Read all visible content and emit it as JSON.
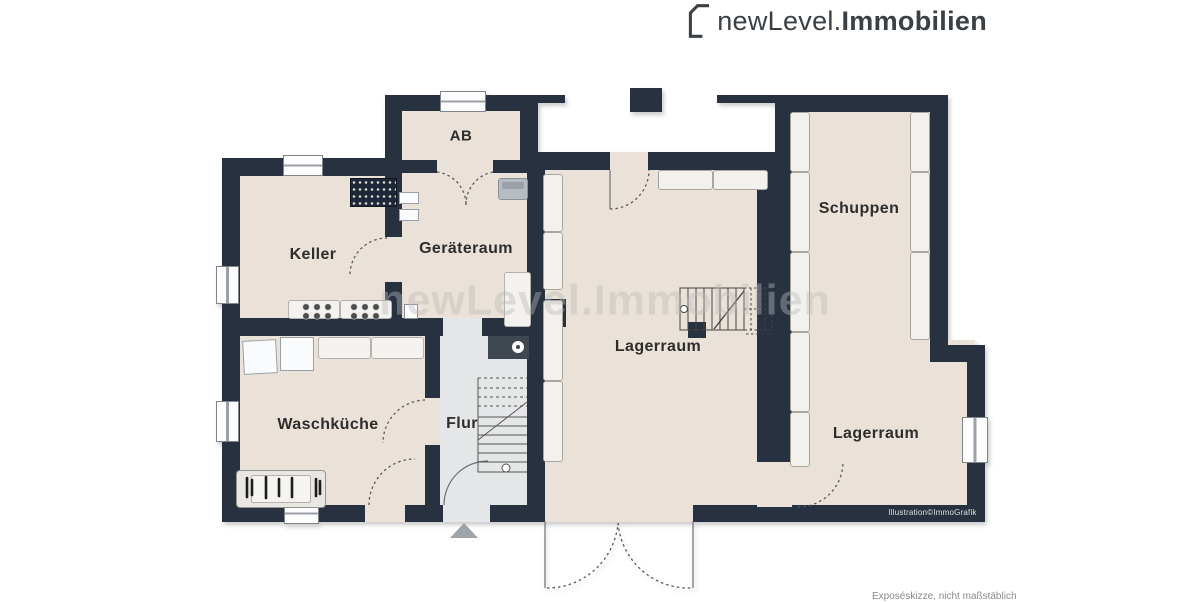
{
  "brand": {
    "logo_prefix": "newLevel.",
    "logo_suffix": "Immobilien"
  },
  "watermark_text": "newLevel.Immobilien",
  "rooms": [
    {
      "label": "AB"
    },
    {
      "label": "Keller"
    },
    {
      "label": "Geräteraum"
    },
    {
      "label": "Waschküche"
    },
    {
      "label": "Flur"
    },
    {
      "label": "Lagerraum"
    },
    {
      "label": "Schuppen"
    },
    {
      "label": "Lagerraum"
    }
  ],
  "credits": {
    "illustration": "Illustration©ImmoGrafik",
    "disclaimer": "Exposéskizze, nicht maßstäblich"
  },
  "colors": {
    "wall": "#273140",
    "floor": "#eae2d8",
    "floor_hall": "#e5e6e8",
    "furniture_light": "#f3f1ed",
    "logo_text": "#3b4045",
    "watermark": "#bababa"
  }
}
